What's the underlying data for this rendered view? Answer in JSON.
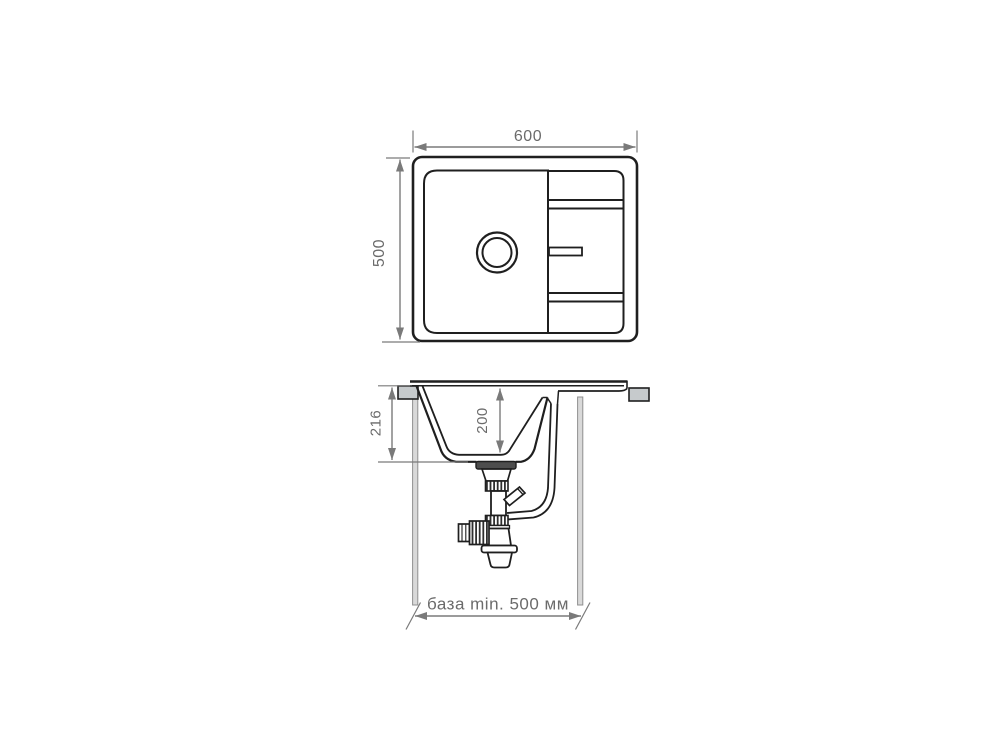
{
  "drawing_title": "sink installation technical drawing",
  "colors": {
    "background": "#ffffff",
    "line": "#1f1f1f",
    "dimension": "#7a7a7a",
    "label_text": "#6b6b6b",
    "clip_fill": "#c6cacc",
    "cabinet_wall_fill": "#d9d9d9",
    "cabinet_wall_stroke": "#8f8f8f",
    "flange_fill": "#4d4d4d"
  },
  "top_view": {
    "width_mm": "600",
    "depth_mm": "500"
  },
  "side_view": {
    "overall_depth_mm": "216",
    "bowl_depth_mm": "200",
    "base_label": "база min. 500 мм"
  }
}
